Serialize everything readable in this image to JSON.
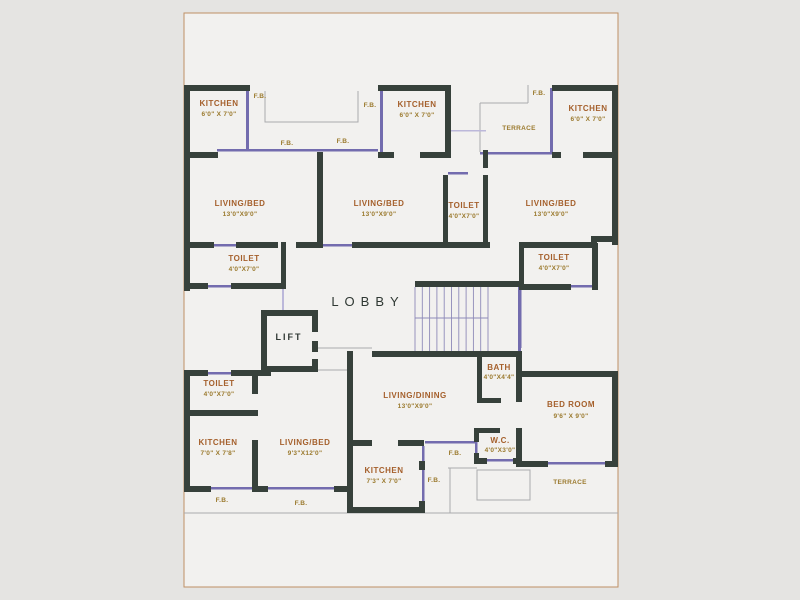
{
  "title": "Floor Plan",
  "colors": {
    "wall": "#37413b",
    "window_line": "#736cae",
    "room_name": "#a5602c",
    "dimension_text": "#9b7a2e",
    "annotation_text": "#2f3833",
    "page_border": "#bf9064",
    "paper": "#f2f1ef"
  },
  "lobby": {
    "label": "LOBBY"
  },
  "lift": {
    "label": "LIFT"
  },
  "rooms": {
    "kitchen_top_left": {
      "name": "KITCHEN",
      "dims": "6'0\" X 7'0\""
    },
    "kitchen_top_middle": {
      "name": "KITCHEN",
      "dims": "6'0\" X 7'0\""
    },
    "kitchen_top_right": {
      "name": "KITCHEN",
      "dims": "6'0\" X 7'0\""
    },
    "living_bed_left": {
      "name": "LIVING/BED",
      "dims": "13'0\"X9'0\""
    },
    "living_bed_middle": {
      "name": "LIVING/BED",
      "dims": "13'0\"X9'0\""
    },
    "living_bed_right": {
      "name": "LIVING/BED",
      "dims": "13'0\"X9'0\""
    },
    "toilet_middle": {
      "name": "TOILET",
      "dims": "4'0\"X7'0\""
    },
    "toilet_upper_left": {
      "name": "TOILET",
      "dims": "4'0\"X7'0\""
    },
    "toilet_right": {
      "name": "TOILET",
      "dims": "4'0\"X7'0\""
    },
    "toilet_lower_left": {
      "name": "TOILET",
      "dims": "4'0\"X7'0\""
    },
    "living_dining": {
      "name": "LIVING/DINING",
      "dims": "13'0\"X9'0\""
    },
    "bath": {
      "name": "BATH",
      "dims": "4'0\"X4'4\""
    },
    "wc": {
      "name": "W.C.",
      "dims": "4'0\"X3'0\""
    },
    "bed_room": {
      "name": "BED ROOM",
      "dims": "9'6\" X 9'0\""
    },
    "kitchen_bottom_left": {
      "name": "KITCHEN",
      "dims": "7'0\" X 7'8\""
    },
    "living_bed_bottom_left": {
      "name": "LIVING/BED",
      "dims": "9'3\"X12'0\""
    },
    "kitchen_bottom_middle": {
      "name": "KITCHEN",
      "dims": "7'3\" X 7'0\""
    },
    "terrace_top": {
      "name": "TERRACE"
    },
    "terrace_bottom": {
      "name": "TERRACE"
    }
  },
  "fb": [
    "F.B.",
    "F.B.",
    "F.B.",
    "F.B.",
    "F.B.",
    "F.B.",
    "F.B.",
    "F.B.",
    "F.B."
  ]
}
